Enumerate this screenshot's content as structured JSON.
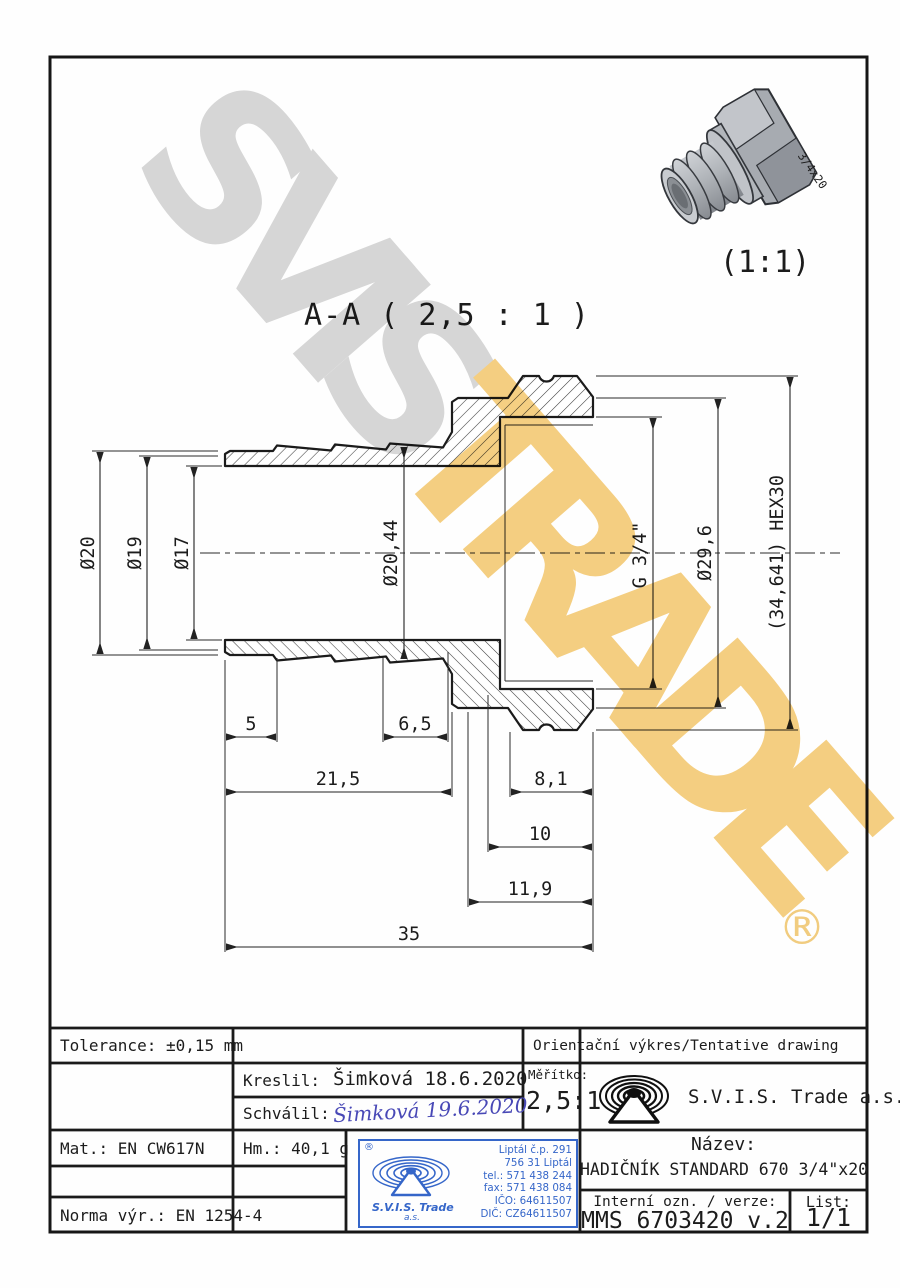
{
  "drawing": {
    "section_label": "A-A ( 2,5 : 1 )",
    "pictorial_scale": "(1:1)",
    "pictorial_marking": "3/4x20",
    "dims": {
      "d20": "Ø20",
      "d19": "Ø19",
      "d17": "Ø17",
      "d2044": "Ø20,44",
      "g34": "G 3/4\"",
      "d296": "Ø29,6",
      "hex": "(34,641) HEX30",
      "l5": "5",
      "l65": "6,5",
      "l215": "21,5",
      "l81": "8,1",
      "l10": "10",
      "l119": "11,9",
      "l35": "35"
    }
  },
  "watermark": {
    "part1": "SVIS",
    "part2": "TRADE",
    "reg": "®"
  },
  "title_block": {
    "tolerance": "Tolerance: ±0,15 mm",
    "orientacni": "Orientační výkres/Tentative drawing",
    "kreslil_label": "Kreslil:",
    "kreslil_value": "Šimková 18.6.2020",
    "schvalil_label": "Schválil:",
    "schvalil_signature": "Šimková 19.6.2020",
    "meritko_label": "Měřítko:",
    "meritko_value": "2,5:1",
    "company": "S.V.I.S. Trade a.s.",
    "mat": "Mat.: EN CW617N",
    "hm": "Hm.: 40,1 g",
    "norma": "Norma výr.: EN 1254-4",
    "nazev_label": "Název:",
    "nazev_value": "HADIČNÍK STANDARD 670 3/4\"x20",
    "interni_label": "Interní ozn. / verze:",
    "interni_value": "MMS 6703420 v.2",
    "list_label": "List:",
    "list_value": "1/1",
    "stamp": {
      "reg": "®",
      "company": "S.V.I.S. Trade",
      "as": "a.s.",
      "lines": [
        "Liptál č.p. 291",
        "756 31 Liptál",
        "tel.: 571 438 244",
        "fax: 571 438 084",
        "IČO: 64611507",
        "DIČ: CZ64611507"
      ]
    }
  },
  "colors": {
    "gold": "#f5cf82",
    "gray": "#d7d7d7",
    "stamp_blue": "#3566c9",
    "signature_blue": "#4848b6"
  }
}
